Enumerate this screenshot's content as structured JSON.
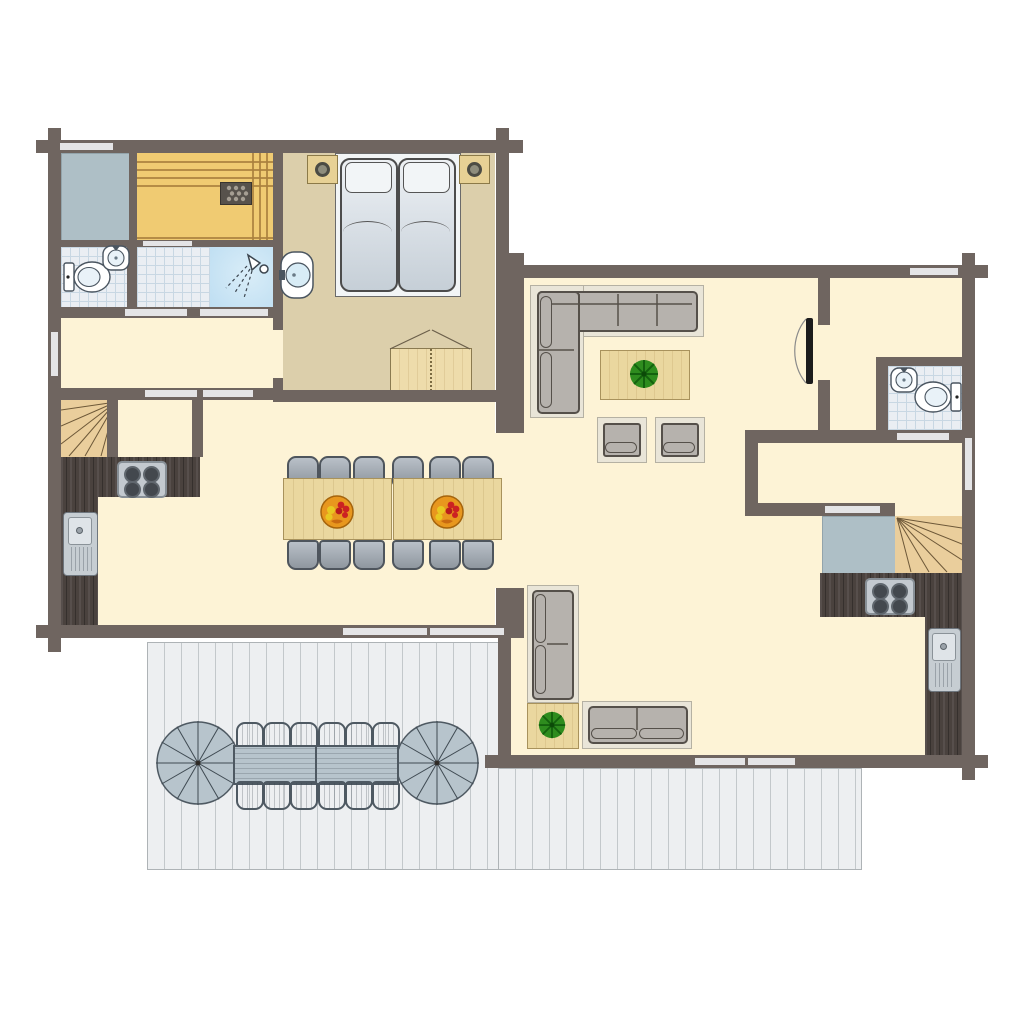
{
  "plan": {
    "type": "floor-plan",
    "buildings": 2,
    "rooms": [
      {
        "name": "technical-room",
        "floor": "gray"
      },
      {
        "name": "sauna",
        "features": [
          "sauna-bench",
          "sauna-heater"
        ]
      },
      {
        "name": "bathroom-left",
        "features": [
          "toilet",
          "washbasin"
        ]
      },
      {
        "name": "shower-room",
        "features": [
          "shower-head"
        ]
      },
      {
        "name": "bedroom",
        "features": [
          "double-bed",
          "pillow x2",
          "nightstand x2",
          "table-lamp x2",
          "washbasin",
          "wardrobe"
        ]
      },
      {
        "name": "hallway",
        "floor": "cream"
      },
      {
        "name": "staircase-left",
        "features": [
          "winder-stairs"
        ]
      },
      {
        "name": "kitchen-left",
        "features": [
          "counter-L",
          "hob-4-burner",
          "sink"
        ]
      },
      {
        "name": "dining-area",
        "features": [
          "dining-table x2",
          "dining-chair x12",
          "fruit-bowl x2"
        ]
      },
      {
        "name": "living-room",
        "features": [
          "corner-sofa",
          "coffee-table",
          "potted-plant",
          "armchair x2",
          "interior-door"
        ]
      },
      {
        "name": "entrance-hall",
        "floor": "cream"
      },
      {
        "name": "bathroom-right",
        "features": [
          "toilet",
          "washbasin"
        ]
      },
      {
        "name": "corridor",
        "floor": "cream"
      },
      {
        "name": "storage-right",
        "floor": "gray"
      },
      {
        "name": "staircase-right",
        "features": [
          "winder-stairs"
        ]
      },
      {
        "name": "kitchen-right",
        "features": [
          "counter-L",
          "hob-4-burner",
          "sink"
        ]
      },
      {
        "name": "sitting-area",
        "features": [
          "sofa x2",
          "side-table",
          "potted-plant"
        ]
      },
      {
        "name": "terrace",
        "features": [
          "deck",
          "outdoor-table x2",
          "outdoor-chair x12",
          "parasol x2"
        ]
      }
    ],
    "counts": {
      "dining_chairs": 12,
      "dining_tables": 2,
      "fruit_bowls": 2,
      "terrace_chairs": 12,
      "terrace_tables": 2,
      "parasols": 2,
      "beds": 1,
      "toilets": 2,
      "washbasins": 4,
      "showers": 1,
      "stoves": 2,
      "kitchen_sinks": 2,
      "staircases": 2,
      "sofas": 3,
      "armchairs": 2,
      "potted_plants": 2,
      "windows": 14
    }
  },
  "colors": {
    "wall": "#6f6560",
    "win": "#e4e4e6",
    "cream": "#fdf3d6",
    "tan": "#dccfab",
    "sauna": "#f0cb72",
    "sauna_line": "#aa813e",
    "tech": "#aebfc6",
    "tech_border": "#93a4ab",
    "tile": "#eaeef3",
    "tile_line": "#c8d7e3",
    "shower": "#bedef2",
    "counter": "#4a423e",
    "table_wood": "#ead79f",
    "wood_border": "#a8925c",
    "chair_border": "#4e555d",
    "outdoor": "#b7c4cc",
    "outdoor_border": "#4e5962",
    "sofa": "#b6b2ad",
    "sofa_border": "#55504a",
    "rug": "#e9e5d8",
    "rug_border": "#b5b1a3",
    "plant": "#2e8c1e",
    "plant_dark": "#14610e",
    "deck": "#edeff1",
    "deck_line": "#c3c8cb",
    "stairs": "#eace9c",
    "stairs_line": "#6d5838",
    "fixture_border": "#4a5560",
    "door_leaf": "#1c1c1c"
  }
}
